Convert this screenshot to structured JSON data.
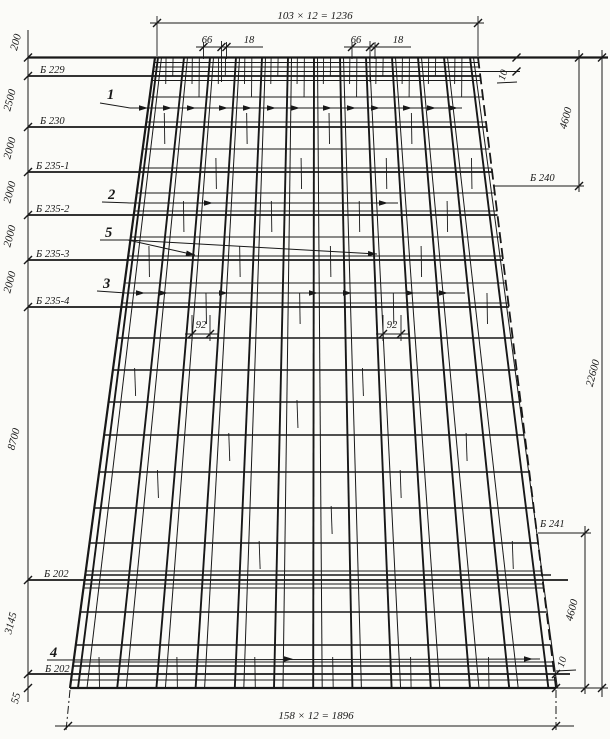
{
  "colors": {
    "ink": "#181818",
    "paper": "#fbfbf8"
  },
  "dims": {
    "top_total": "103 × 12 = 1236",
    "bottom_total": "158 × 12 = 1896",
    "height_total": "22600",
    "right_upper": "4600",
    "right_lower": "4600",
    "gap_top_right": "10",
    "gap_bottom_right": "10",
    "top_66_a": "66",
    "top_18_a": "18",
    "top_66_b": "66",
    "top_18_b": "18",
    "mid_92_a": "92",
    "mid_92_b": "92",
    "left_200": "200",
    "left_2500": "2500",
    "left_2000_1": "2000",
    "left_2000_2": "2000",
    "left_2000_3": "2000",
    "left_2000_4": "2000",
    "left_8700": "8700",
    "left_3145": "3145",
    "left_55": "55"
  },
  "beams": {
    "b229": "Б 229",
    "b230": "Б 230",
    "b235_1": "Б 235-1",
    "b235_2": "Б 235-2",
    "b235_3": "Б 235-3",
    "b235_4": "Б 235-4",
    "b202_top": "Б 202",
    "b202_bottom": "Б 202",
    "b240": "Б 240",
    "b241": "Б 241"
  },
  "callouts": {
    "c1": "1",
    "c2": "2",
    "c3": "3",
    "c4": "4",
    "c5": "5"
  }
}
